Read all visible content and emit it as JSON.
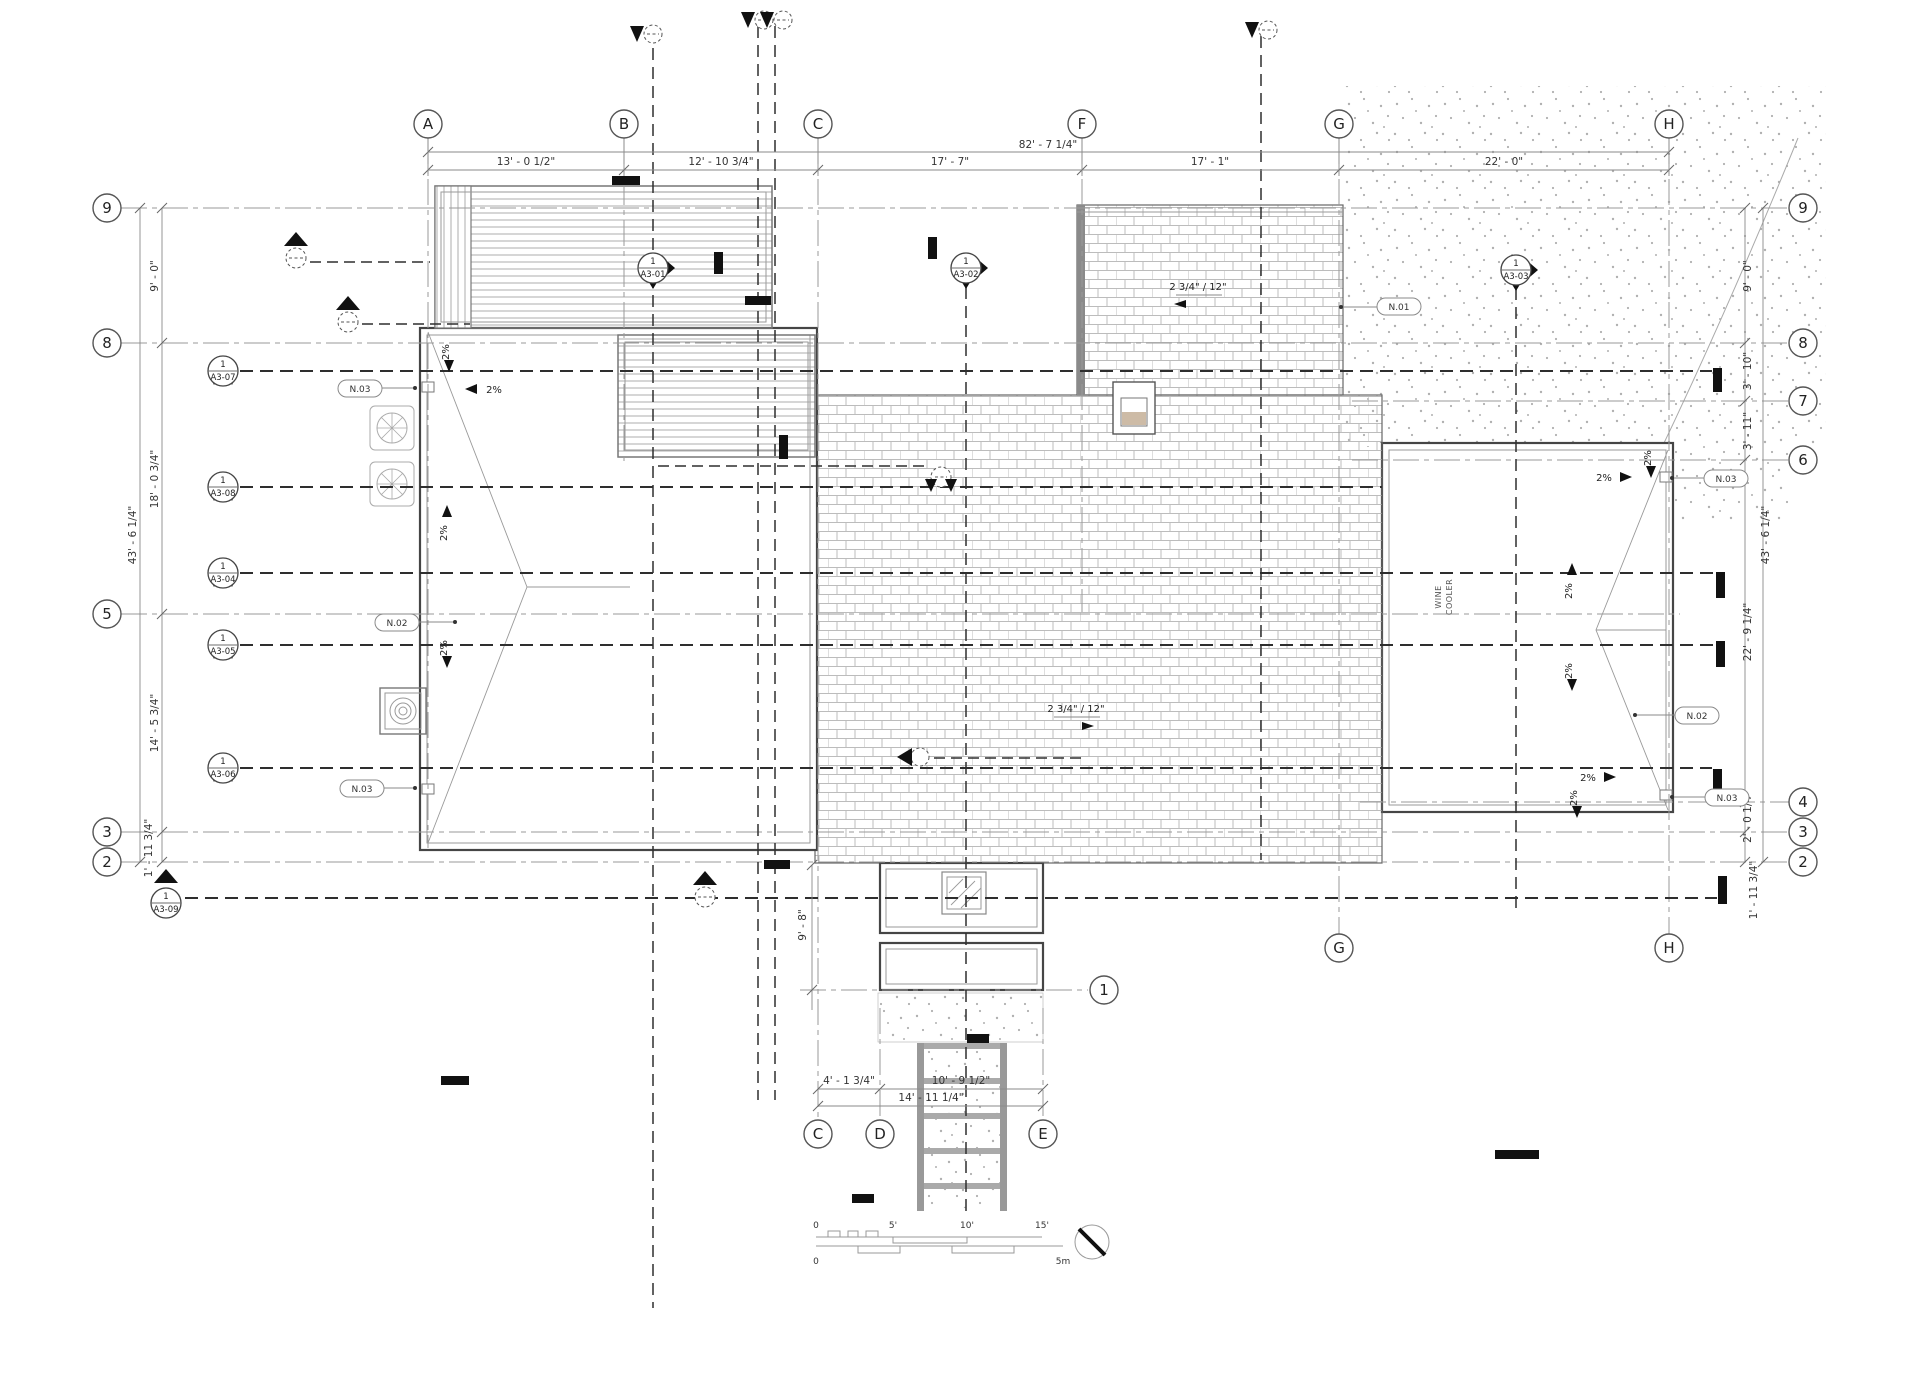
{
  "sheet": {
    "kind": "roof-plan",
    "bg": "#ffffff"
  },
  "colors": {
    "edge": "#454545",
    "grid": "#9a9a9a",
    "section": "#2e2e2e",
    "brick": "#bcbcbc",
    "stipple": "#b0b0b0",
    "hatch_tan": "#cdbba6"
  },
  "grid": {
    "top": [
      {
        "label": "A"
      },
      {
        "label": "B"
      },
      {
        "label": "C"
      },
      {
        "label": "F"
      },
      {
        "label": "G"
      },
      {
        "label": "H"
      }
    ],
    "bottom": [
      {
        "label": "C"
      },
      {
        "label": "D"
      },
      {
        "label": "E"
      }
    ],
    "bottom_right": [
      {
        "label": "G"
      },
      {
        "label": "H"
      }
    ],
    "left": [
      {
        "label": "9"
      },
      {
        "label": "8"
      },
      {
        "label": "5"
      },
      {
        "label": "3"
      },
      {
        "label": "2"
      }
    ],
    "right": [
      {
        "label": "9"
      },
      {
        "label": "8"
      },
      {
        "label": "7"
      },
      {
        "label": "6"
      },
      {
        "label": "4"
      },
      {
        "label": "3"
      },
      {
        "label": "2"
      }
    ],
    "one": {
      "label": "1"
    }
  },
  "dims": {
    "top": [
      "82' - 7 1/4\"",
      "13' - 0 1/2\"",
      "12' - 10 3/4\"",
      "17' - 7\"",
      "17' - 1\"",
      "22' - 0\""
    ],
    "left": [
      "9' - 0\"",
      "18' - 0 3/4\"",
      "14' - 5 3/4\"",
      "1' - 11 3/4\"",
      "43' - 6 1/4\""
    ],
    "right": [
      "9' - 0\"",
      "3' - 10\"",
      "3' - 11\"",
      "22' - 9 1/4\"",
      "2' - 0 1/4\"",
      "1' - 11 3/4\"",
      "43' - 6 1/4\""
    ],
    "bottom": [
      "4' - 1 3/4\"",
      "10' - 9 1/2\"",
      "14' - 11 1/4\"",
      "9' - 8\""
    ]
  },
  "sections": [
    {
      "num": "1",
      "sheet": "A3-01"
    },
    {
      "num": "1",
      "sheet": "A3-02"
    },
    {
      "num": "1",
      "sheet": "A3-03"
    },
    {
      "num": "1",
      "sheet": "A3-04"
    },
    {
      "num": "1",
      "sheet": "A3-05"
    },
    {
      "num": "1",
      "sheet": "A3-06"
    },
    {
      "num": "1",
      "sheet": "A3-07"
    },
    {
      "num": "1",
      "sheet": "A3-08"
    },
    {
      "num": "1",
      "sheet": "A3-09"
    }
  ],
  "notes": [
    "N.01",
    "N.02",
    "N.03"
  ],
  "slope_label": "2%",
  "pitch_label": "2 3/4\" / 12\"",
  "room": [
    "WINE",
    "COOLER"
  ],
  "scalebar": {
    "imperial": [
      "0",
      "5'",
      "10'",
      "15'"
    ],
    "metric": [
      "0",
      "5m"
    ]
  }
}
